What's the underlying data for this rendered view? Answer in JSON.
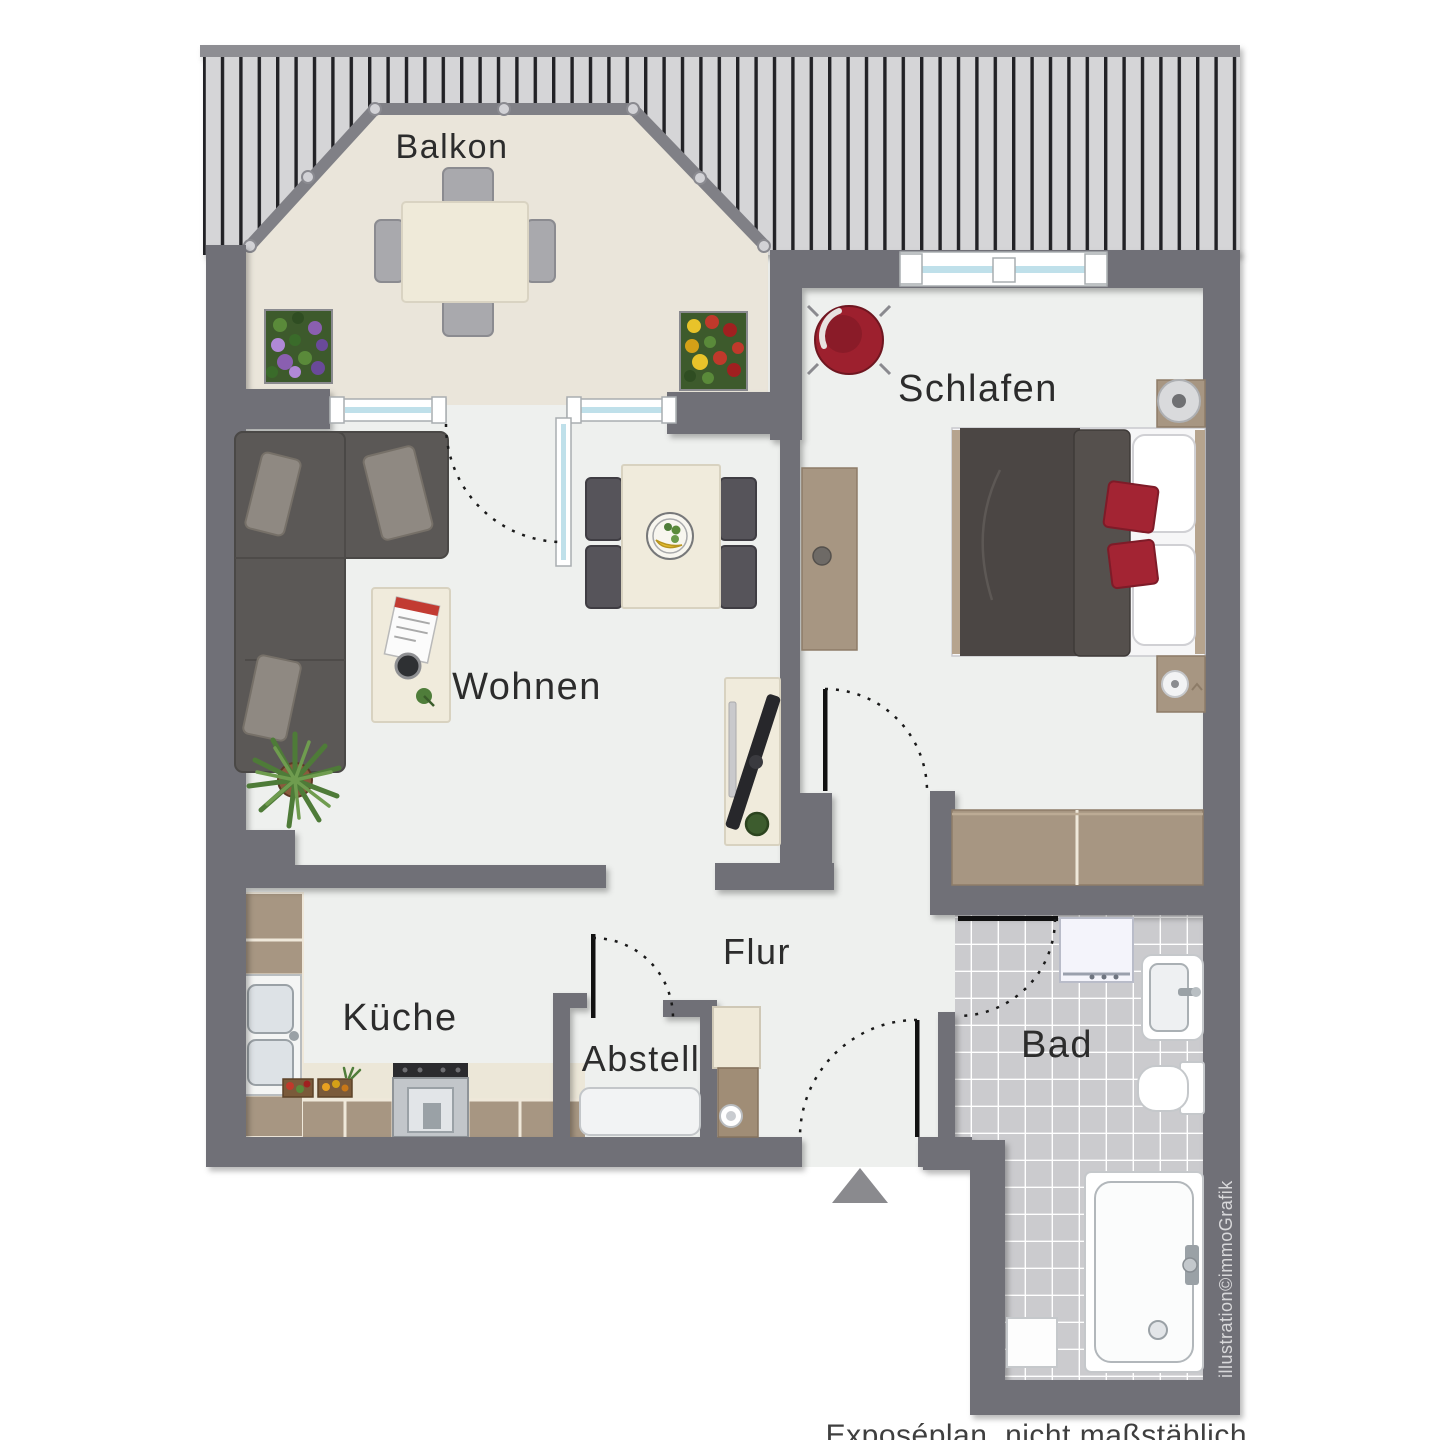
{
  "rooms": {
    "balkon": {
      "label": "Balkon"
    },
    "schlafen": {
      "label": "Schlafen"
    },
    "wohnen": {
      "label": "Wohnen"
    },
    "kueche": {
      "label": "Küche"
    },
    "abstell": {
      "label": "Abstell"
    },
    "flur": {
      "label": "Flur"
    },
    "bad": {
      "label": "Bad"
    }
  },
  "footer": {
    "disclaimer": "Exposéplan, nicht maßstäblich"
  },
  "credit": {
    "text": "illustration©immoGrafik"
  },
  "colors": {
    "wall": "#6f6f77",
    "roof_bar": "#8e8e93",
    "roof_hatch_bg": "#d5d5d7",
    "roof_hatch_line": "#222226",
    "floor": "#eef0ee",
    "balcony_floor": "#eae5da",
    "bath_tile": "#cbcbce",
    "wood": "#a79682",
    "light_wood": "#f0ebdc",
    "sofa": "#5b5856",
    "accent_red": "#9d202e",
    "window_glass": "#bfe0ea",
    "label_text": "#2c2c2c",
    "footer_text": "#3f3f3f",
    "credit_text": "#d8d8da"
  }
}
